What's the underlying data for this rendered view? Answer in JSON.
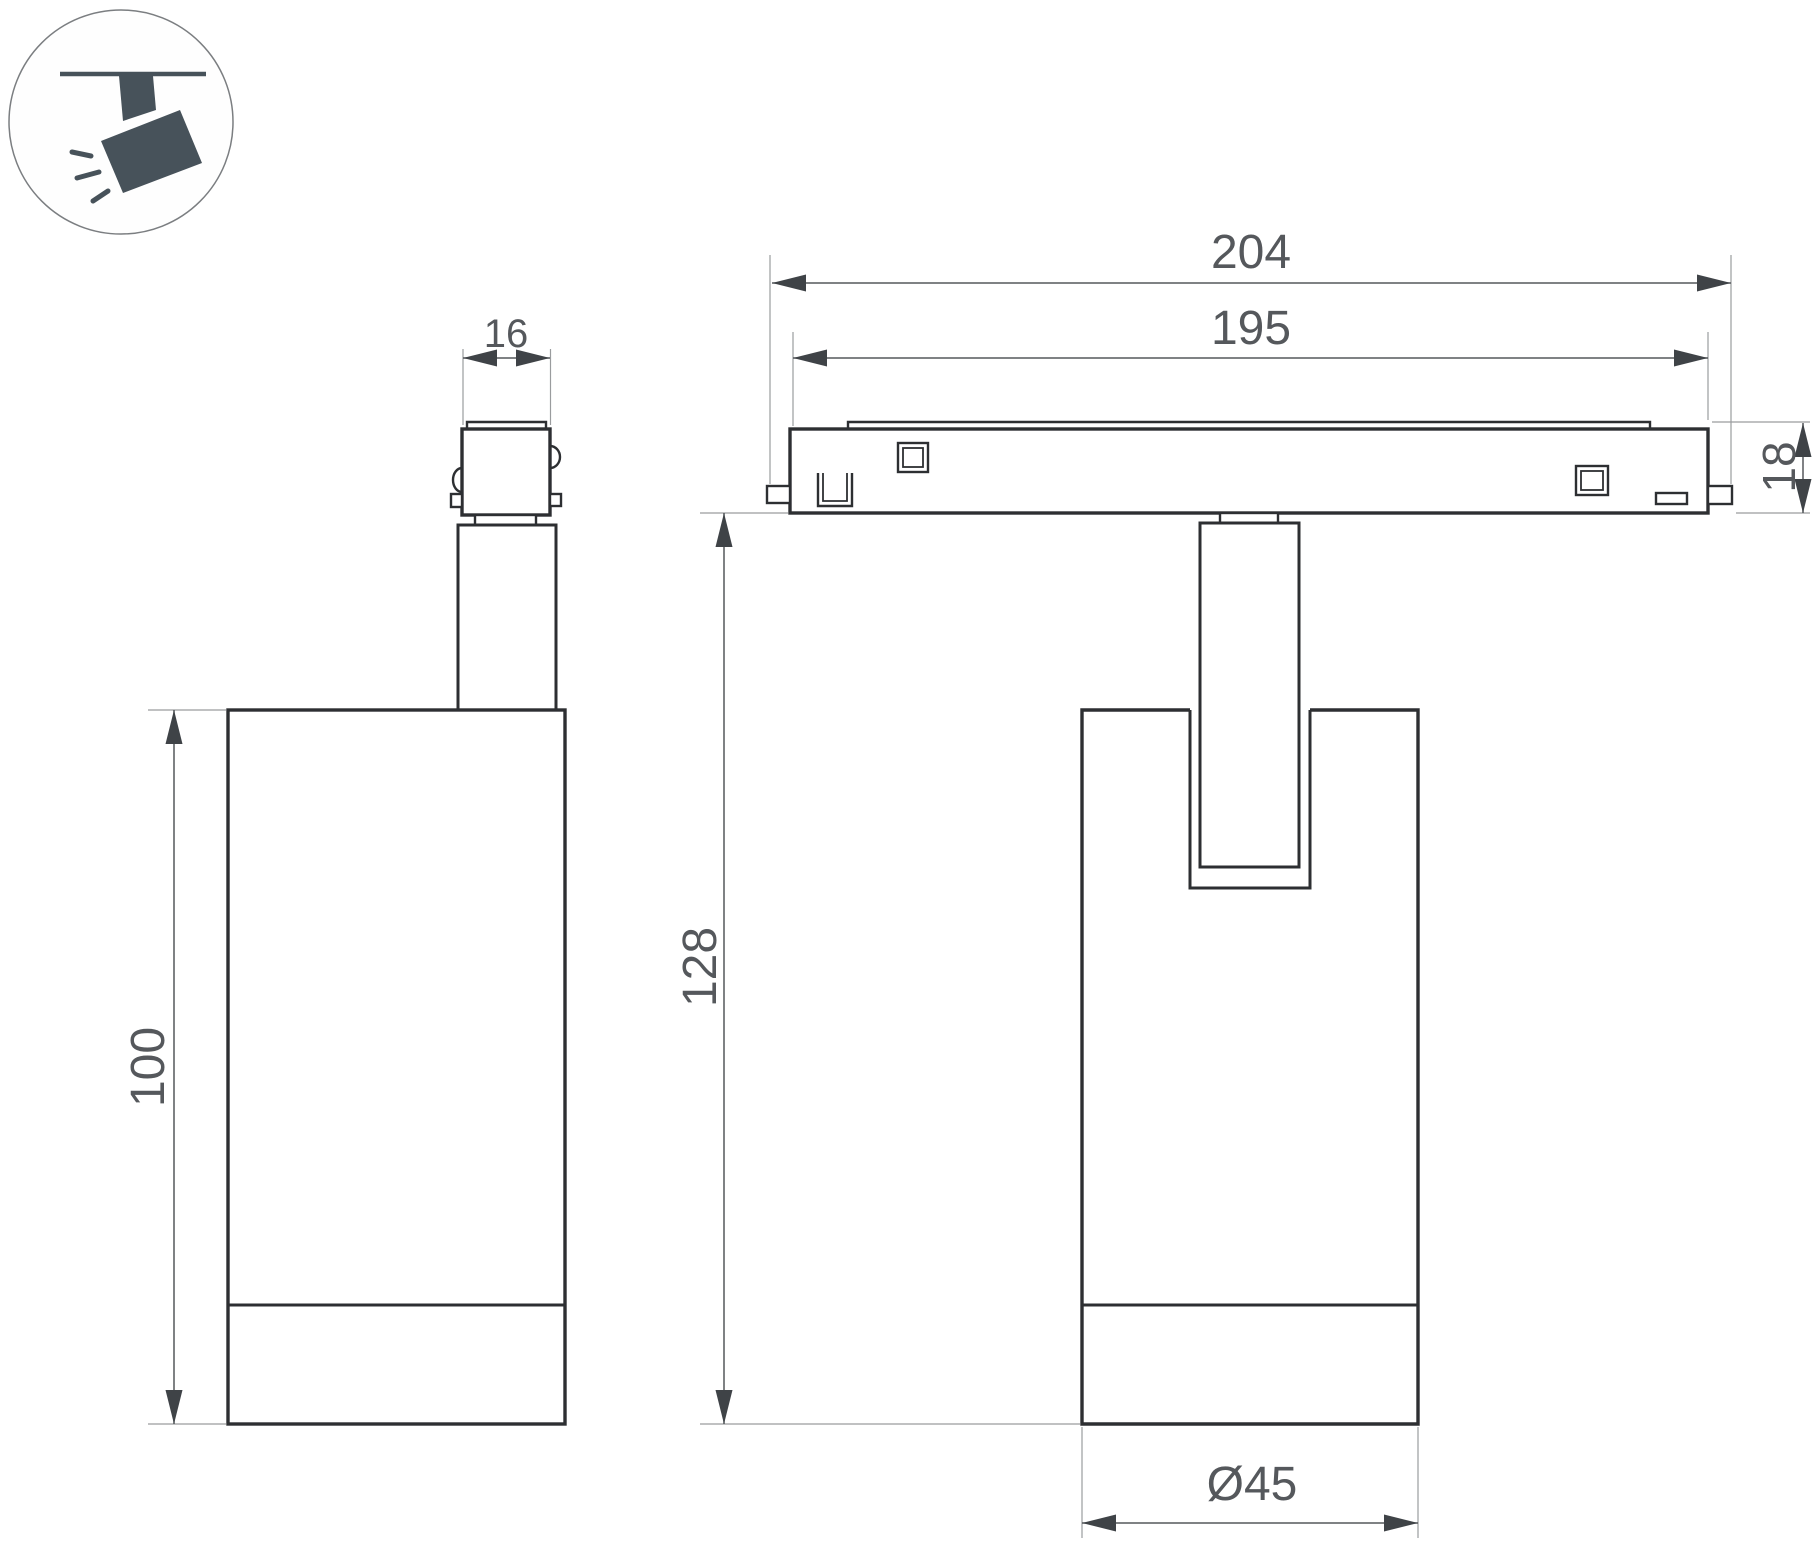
{
  "title": "track-spotlight-dimension-drawing",
  "icon": {
    "name": "ceiling-track-spotlight-icon",
    "color": "#47525A"
  },
  "dims": {
    "track_outer": "204",
    "track_inner": "195",
    "track_height": "18",
    "adapter_width": "16",
    "overall_height": "128",
    "body_height": "100",
    "body_diameter": "Ø45"
  },
  "colors": {
    "outline": "#2D2F32",
    "dimension_line": "#55585C",
    "extension_line": "#9A9C9E",
    "text": "#55585C",
    "icon": "#47525A",
    "background": "#FFFFFF"
  }
}
